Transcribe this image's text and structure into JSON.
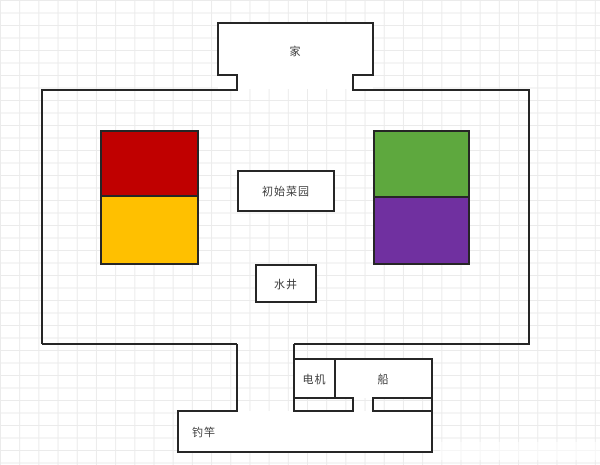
{
  "canvas": {
    "width": 600,
    "height": 465
  },
  "colors": {
    "outline": "#262626",
    "grid_line": "#ebebeb",
    "background": "#ffffff",
    "label_text": "#3d3d3d"
  },
  "rooms": {
    "home": {
      "label": "家"
    },
    "garden": {
      "label": "初始菜园"
    },
    "well": {
      "label": "水井"
    },
    "motor": {
      "label": "电机"
    },
    "boat": {
      "label": "船"
    },
    "fishing_rod": {
      "label": "钓竿"
    }
  },
  "blocks": [
    {
      "name": "red-block",
      "color": "#c00000"
    },
    {
      "name": "yellow-block",
      "color": "#ffc000"
    },
    {
      "name": "green-block",
      "color": "#5ea83e"
    },
    {
      "name": "purple-block",
      "color": "#7030a0"
    }
  ]
}
